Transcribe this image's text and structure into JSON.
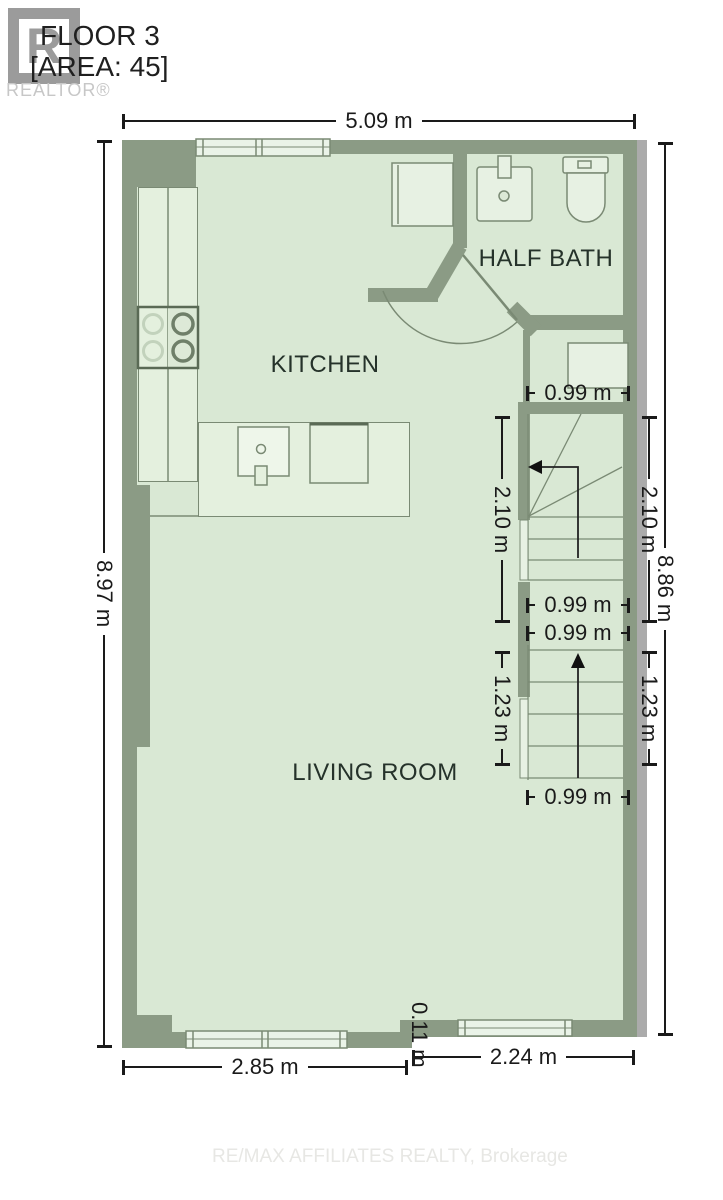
{
  "header": {
    "title": "FLOOR 3",
    "area": "[AREA: 45]",
    "logo_letter": "R",
    "realtor_label": "REALTOR®"
  },
  "rooms": {
    "kitchen": "KITCHEN",
    "half_bath": "HALF BATH",
    "living_room": "LIVING ROOM"
  },
  "dimensions": {
    "top_width": "5.09 m",
    "left_height": "8.97 m",
    "right_height": "8.86 m",
    "closet_width": "0.99 m",
    "stair_upper_left": "2.10 m",
    "stair_upper_right": "2.10 m",
    "stair_mid_upper": "0.99 m",
    "stair_mid_lower": "0.99 m",
    "stair_lower_left": "1.23 m",
    "stair_lower_right": "1.23 m",
    "stair_bottom_width": "0.99 m",
    "bottom_left_width": "2.85 m",
    "bottom_right_width": "2.24 m",
    "wall_offset": "0.11 m"
  },
  "footer": {
    "brokerage": "RE/MAX AFFILIATES REALTY, Brokerage"
  },
  "colors": {
    "wall": "#8b9b85",
    "floor": "#d9e8d4",
    "fixture_fill": "#e7f1e3",
    "outline": "#7a8a74",
    "party_wall": "#ababab",
    "dimension_text": "#1a1a1a"
  }
}
